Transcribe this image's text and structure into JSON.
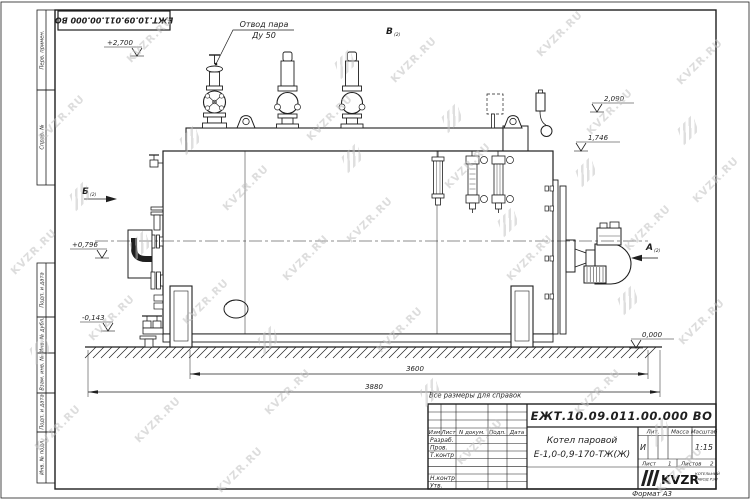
{
  "watermark": {
    "text": "KVZR.RU"
  },
  "stamp": {
    "code": "ЕЖТ.10.09.011.00.000  ВО"
  },
  "frame_labels": {
    "perv_primen": "Перв. примен.",
    "sprav_no": "Справ. №",
    "podp_data_1": "Подп. и дата",
    "inv_dubl": "Инв. № дубл.",
    "vzam_inv": "Взам. инв. №",
    "podp_data_2": "Подп. и дата",
    "inv_podl": "Инв. № подл."
  },
  "annotations": {
    "steam_outlet_line1": "Отвод пара",
    "steam_outlet_line2": "Ду 50",
    "view_v": "В",
    "view_b": "Б",
    "view_a": "А",
    "view_sheet_ref": "(2)",
    "elev_2700": "+2,700",
    "elev_2090": "2,090",
    "elev_1746": "1,746",
    "elev_0796": "+0,796",
    "elev_m0143": "-0,143",
    "elev_0000": "0,000",
    "dim_3600": "3600",
    "dim_3880": "3880",
    "note": "Все размеры для справок"
  },
  "title_block": {
    "doc_number": "ЕЖТ.10.09.011.00.000  ВО",
    "product_name_line1": "Котел паровой",
    "product_name_line2": "Е-1,0-0,9-170-ТЖ(Ж)",
    "col_izm": "Изм",
    "col_list": "Лист",
    "col_ndokum": "N докум.",
    "col_podp": "Подп.",
    "col_data": "Дата",
    "row_razrab": "Разраб.",
    "row_prov": "Пров.",
    "row_tkontr": "Т.контр",
    "row_nkontr": "Н.контр",
    "row_utv": "Утв.",
    "lit_header": "Лит.",
    "massa_header": "Масса",
    "masshtab_header": "Масштаб",
    "lit_value": "И",
    "scale_value": "1:15",
    "sheet_label": "Лист",
    "sheet_value": "1",
    "sheets_label": "Листов",
    "sheets_value": "2",
    "logo_text": "KVZR",
    "logo_sub_line1": "КОТЕЛЬНЫЙ",
    "logo_sub_line2": "ЗАВОД РЭП",
    "format_label": "Формат  А3"
  },
  "colors": {
    "line": "#1f1f1f",
    "watermark": "#c3c3c3",
    "background": "#ffffff"
  }
}
